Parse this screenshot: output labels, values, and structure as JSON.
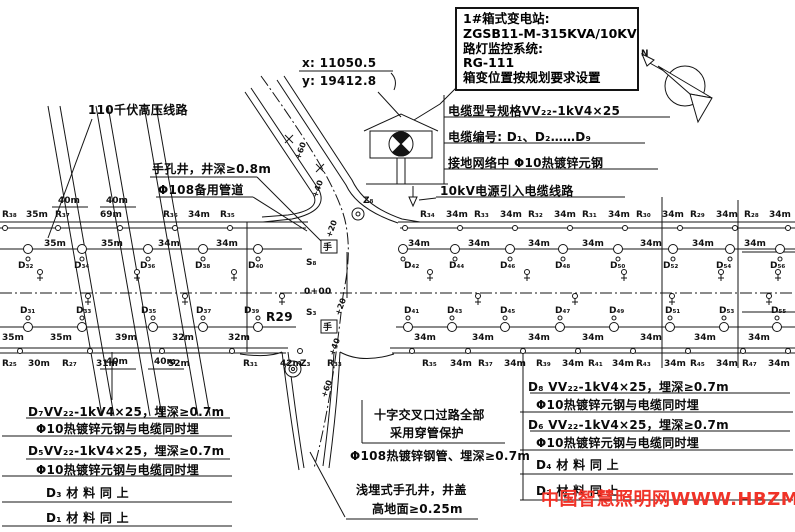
{
  "callout": {
    "l1": "1#箱式变电站:",
    "l2": "ZGSB11-M-315KVA/10KV",
    "l3": "路灯监控系统:",
    "l4": "RG-111",
    "l5": "箱变位置按规划要求设置"
  },
  "coords": {
    "x": "x: 11050.5",
    "y": "y: 19412.8"
  },
  "labels": {
    "hv_line": "110千伏高压线路",
    "hand_well": "手孔井，井深≥0.8m",
    "spare_duct": "Φ108备用管道",
    "cable_spec": "电缆型号规格VV₂₂-1kV4×25",
    "cable_numbers": "电缆编号: D₁、D₂……D₉",
    "ground_net": "接地网络中 Φ10热镀锌元钢",
    "power_in": "10kV电源引入电缆线路",
    "crossing_1": "十字交叉口过路全部",
    "crossing_2": "采用穿管保护",
    "steel_pipe": "Φ108热镀锌钢管、埋深≥0.7m",
    "shallow_1": "浅埋式手孔井，井盖",
    "shallow_2": "高地面≥0.25m",
    "r29": "R29",
    "station_zero": "0+00",
    "watermark": "中国智慧照明网WWW.HBZM.CN"
  },
  "notes_left": {
    "r1l1": "D₇VV₂₂-1kV4×25，埋深≥0.7m",
    "r1l2": "Φ10热镀锌元钢与电缆同时埋",
    "r2l1": "D₅VV₂₂-1kV4×25，埋深≥0.7m",
    "r2l2": "Φ10热镀锌元钢与电缆同时埋",
    "r3": "D₃ 材 料 同 上",
    "r4": "D₁ 材 料 同 上"
  },
  "notes_right": {
    "r1l1": "D₈ VV₂₂-1kV4×25，埋深≥0.7m",
    "r1l2": "Φ10热镀锌元钢与电缆同时埋",
    "r2l1": "D₆ VV₂₂-1kV4×25，埋深≥0.7m",
    "r2l2": "Φ10热镀锌元钢与电缆同时埋",
    "r3": "D₄ 材 料 同 上",
    "r4": "D₂ 材 料 同 上"
  },
  "svg": {
    "text_rows": [
      {
        "name": "top-edge-pole-row",
        "y": 217,
        "cls": "rt",
        "items": [
          {
            "t": "R₃₈",
            "x": 2
          },
          {
            "t": "35m",
            "x": 26
          },
          {
            "t": "R₃₇",
            "x": 55
          },
          {
            "t": "69m",
            "x": 100
          },
          {
            "t": "R₃₆",
            "x": 163
          },
          {
            "t": "34m",
            "x": 188
          },
          {
            "t": "R₃₅",
            "x": 220
          },
          {
            "t": "R₃₄",
            "x": 420
          },
          {
            "t": "34m",
            "x": 446
          },
          {
            "t": "R₃₃",
            "x": 474
          },
          {
            "t": "34m",
            "x": 500
          },
          {
            "t": "R₃₂",
            "x": 528
          },
          {
            "t": "34m",
            "x": 554
          },
          {
            "t": "R₃₁",
            "x": 582
          },
          {
            "t": "34m",
            "x": 608
          },
          {
            "t": "R₃₀",
            "x": 636
          },
          {
            "t": "34m",
            "x": 662
          },
          {
            "t": "R₂₉",
            "x": 690
          },
          {
            "t": "34m",
            "x": 716
          },
          {
            "t": "R₂₈",
            "x": 744
          },
          {
            "t": "34m",
            "x": 769
          }
        ]
      },
      {
        "name": "top-lamp-distance-row",
        "y": 246,
        "cls": "rt",
        "items": [
          {
            "t": "35m",
            "x": 44
          },
          {
            "t": "35m",
            "x": 101
          },
          {
            "t": "34m",
            "x": 158
          },
          {
            "t": "34m",
            "x": 216
          },
          {
            "t": "34m",
            "x": 408
          },
          {
            "t": "34m",
            "x": 468
          },
          {
            "t": "34m",
            "x": 528
          },
          {
            "t": "34m",
            "x": 582
          },
          {
            "t": "34m",
            "x": 640
          },
          {
            "t": "34m",
            "x": 692
          },
          {
            "t": "34m",
            "x": 744
          }
        ]
      },
      {
        "name": "top-cable-segment-row",
        "y": 268,
        "cls": "rt",
        "items": [
          {
            "t": "D₃₂",
            "x": 18
          },
          {
            "t": "D₃₄",
            "x": 74
          },
          {
            "t": "D₃₆",
            "x": 140
          },
          {
            "t": "D₃₈",
            "x": 195
          },
          {
            "t": "D₄₀",
            "x": 248
          },
          {
            "t": "D₄₂",
            "x": 404
          },
          {
            "t": "D₄₄",
            "x": 449
          },
          {
            "t": "D₄₆",
            "x": 500
          },
          {
            "t": "D₄₈",
            "x": 555
          },
          {
            "t": "D₅₀",
            "x": 610
          },
          {
            "t": "D₅₂",
            "x": 663
          },
          {
            "t": "D₅₄",
            "x": 716
          },
          {
            "t": "D₅₆",
            "x": 770
          }
        ]
      },
      {
        "name": "bottom-cable-segment-row",
        "y": 313,
        "cls": "rt",
        "items": [
          {
            "t": "D₃₁",
            "x": 20
          },
          {
            "t": "D₃₃",
            "x": 76
          },
          {
            "t": "D₃₅",
            "x": 141
          },
          {
            "t": "D₃₇",
            "x": 196
          },
          {
            "t": "D₃₉",
            "x": 244
          },
          {
            "t": "D₄₁",
            "x": 404
          },
          {
            "t": "D₄₃",
            "x": 447
          },
          {
            "t": "D₄₅",
            "x": 500
          },
          {
            "t": "D₄₇",
            "x": 555
          },
          {
            "t": "D₄₉",
            "x": 609
          },
          {
            "t": "D₅₁",
            "x": 665
          },
          {
            "t": "D₅₃",
            "x": 719
          },
          {
            "t": "D₅₅",
            "x": 771
          }
        ]
      },
      {
        "name": "bottom-lamp-distance-row",
        "y": 340,
        "cls": "rt",
        "items": [
          {
            "t": "35m",
            "x": 2
          },
          {
            "t": "35m",
            "x": 50
          },
          {
            "t": "39m",
            "x": 115
          },
          {
            "t": "32m",
            "x": 172
          },
          {
            "t": "32m",
            "x": 228
          },
          {
            "t": "34m",
            "x": 414
          },
          {
            "t": "34m",
            "x": 472
          },
          {
            "t": "34m",
            "x": 528
          },
          {
            "t": "34m",
            "x": 582
          },
          {
            "t": "34m",
            "x": 640
          },
          {
            "t": "34m",
            "x": 694
          },
          {
            "t": "34m",
            "x": 748
          }
        ]
      },
      {
        "name": "bottom-edge-pole-row",
        "y": 366,
        "cls": "rt",
        "items": [
          {
            "t": "R₂₅",
            "x": 2
          },
          {
            "t": "30m",
            "x": 28
          },
          {
            "t": "R₂₇",
            "x": 62
          },
          {
            "t": "31m",
            "x": 96
          },
          {
            "t": "52m",
            "x": 168
          },
          {
            "t": "R₃₁",
            "x": 243
          },
          {
            "t": "42m",
            "x": 280
          },
          {
            "t": "R₃₃",
            "x": 327
          },
          {
            "t": "R₃₅",
            "x": 422
          },
          {
            "t": "34m",
            "x": 450
          },
          {
            "t": "R₃₇",
            "x": 478
          },
          {
            "t": "34m",
            "x": 504
          },
          {
            "t": "R₃₉",
            "x": 536
          },
          {
            "t": "34m",
            "x": 562
          },
          {
            "t": "R₄₁",
            "x": 588
          },
          {
            "t": "34m",
            "x": 612
          },
          {
            "t": "R₄₃",
            "x": 636
          },
          {
            "t": "34m",
            "x": 664
          },
          {
            "t": "R₄₅",
            "x": 690
          },
          {
            "t": "34m",
            "x": 716
          },
          {
            "t": "R₄₇",
            "x": 742
          },
          {
            "t": "34m",
            "x": 768
          }
        ]
      }
    ],
    "circle_rows": [
      {
        "name": "top-curb-junction",
        "y": 228,
        "r": 2.5,
        "xs": [
          5,
          58,
          120,
          175,
          230,
          405,
          460,
          515,
          570,
          625,
          680,
          735,
          788
        ]
      },
      {
        "name": "top-lamp",
        "y": 249,
        "r": 4.5,
        "xs": [
          28,
          82,
          148,
          203,
          258,
          403,
          455,
          510,
          563,
          618,
          673,
          730,
          780
        ]
      },
      {
        "name": "bottom-lamp",
        "y": 327,
        "r": 4.5,
        "xs": [
          28,
          82,
          153,
          203,
          258,
          408,
          452,
          505,
          560,
          614,
          670,
          724,
          777
        ]
      },
      {
        "name": "bottom-curb-junction",
        "y": 351,
        "r": 2.5,
        "xs": [
          20,
          90,
          162,
          232,
          300,
          412,
          468,
          523,
          578,
          633,
          688,
          743,
          788
        ]
      }
    ],
    "hook_rows": [
      {
        "name": "top-lamp-hook",
        "y": 259,
        "r": 2,
        "xs": [
          28,
          82,
          148,
          203,
          258,
          403,
          455,
          510,
          563,
          618,
          673,
          730,
          780
        ]
      },
      {
        "name": "bottom-lamp-hook",
        "y": 318,
        "r": 2,
        "xs": [
          28,
          82,
          153,
          203,
          258,
          408,
          452,
          505,
          560,
          614,
          670,
          724,
          777
        ]
      }
    ],
    "shrub_rows": [
      {
        "y": 272,
        "xs": [
          40,
          137,
          234,
          430,
          527,
          624,
          721,
          778
        ]
      },
      {
        "y": 296,
        "xs": [
          88,
          185,
          282,
          478,
          575,
          672,
          769
        ]
      }
    ],
    "rot_labels": [
      {
        "t": "+60",
        "x": 300,
        "y": 160
      },
      {
        "t": "+40",
        "x": 317,
        "y": 198
      },
      {
        "t": "+20",
        "x": 331,
        "y": 238
      },
      {
        "t": "+20",
        "x": 340,
        "y": 316
      },
      {
        "t": "+40",
        "x": 334,
        "y": 356
      },
      {
        "t": "+60",
        "x": 326,
        "y": 398
      }
    ],
    "free_labels": [
      {
        "t": "Z₈",
        "x": 363,
        "y": 203,
        "cls": "rt",
        "name": "junction-label-z8"
      },
      {
        "t": "Z₃",
        "x": 300,
        "y": 366,
        "cls": "rt",
        "name": "junction-label-z3"
      },
      {
        "t": "S₈",
        "x": 306,
        "y": 265,
        "cls": "rt",
        "name": "well-number-s8"
      },
      {
        "t": "S₃",
        "x": 306,
        "y": 315,
        "cls": "rt",
        "name": "well-number-s3"
      },
      {
        "t": "手",
        "x": 323,
        "y": 250,
        "cls": "well",
        "name": "hand-well-mark-top"
      },
      {
        "t": "手",
        "x": 323,
        "y": 330,
        "cls": "well",
        "name": "hand-well-mark-bottom"
      },
      {
        "t": "N",
        "x": 641,
        "y": 56,
        "cls": "rt",
        "name": "north-letter"
      },
      {
        "t": "40m",
        "x": 58,
        "y": 203,
        "cls": "dim",
        "name": "dim-40m"
      },
      {
        "t": "40m",
        "x": 106,
        "y": 203,
        "cls": "dim",
        "name": "dim-40m"
      },
      {
        "t": "40m",
        "x": 106,
        "y": 364,
        "cls": "dim",
        "name": "dim-40m"
      },
      {
        "t": "40m",
        "x": 154,
        "y": 364,
        "cls": "dim",
        "name": "dim-40m"
      }
    ]
  }
}
